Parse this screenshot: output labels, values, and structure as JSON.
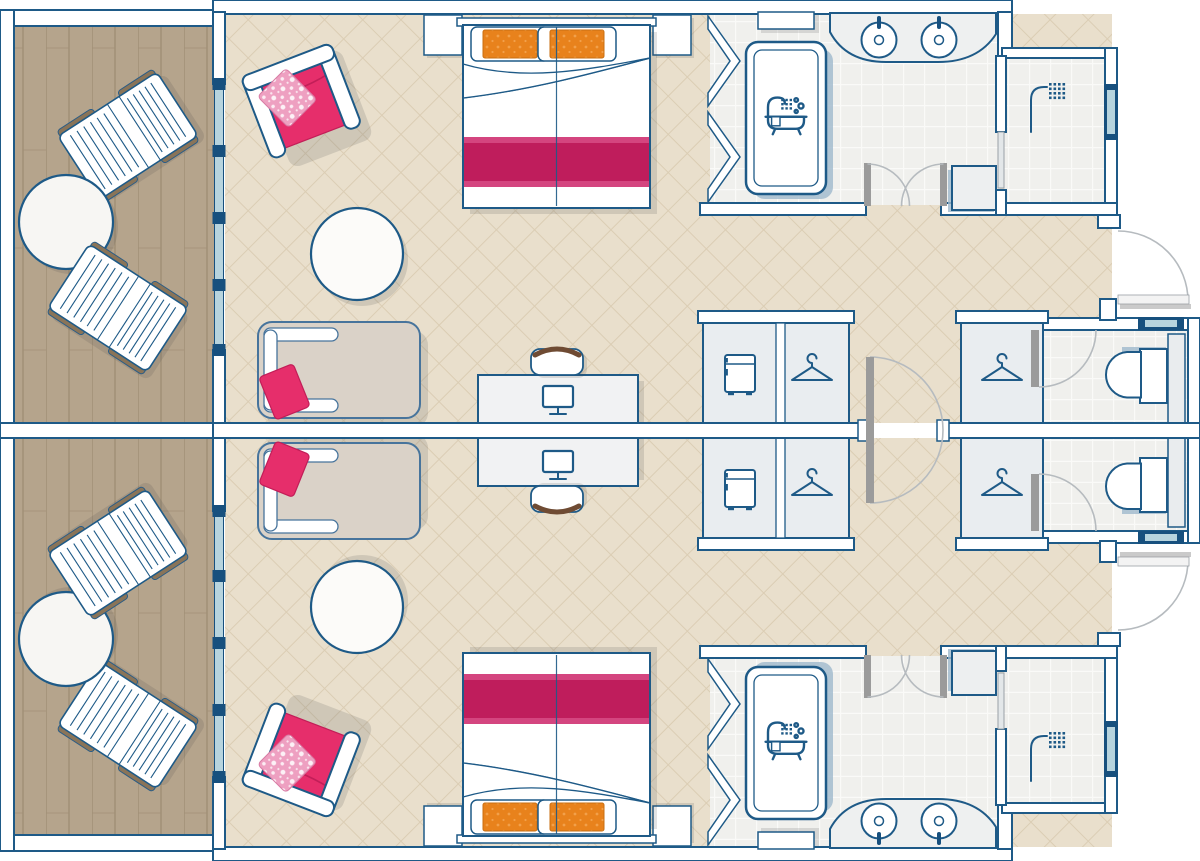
{
  "document": {
    "type": "floor-plan",
    "description": "Floor plan of two mirrored connecting hotel rooms, each with balcony, bedroom, walk-in closets, bathroom, shower room and WC",
    "visible_text": []
  },
  "palette": {
    "wall_stroke": "#1e5a87",
    "wall_fill": "#ffffff",
    "floor_bedroom": "#e9dfcc",
    "floor_grid": "#dbcdb4",
    "floor_deck": "#b5a48c",
    "deck_line": "#a08f76",
    "floor_tile": "#f0f0ed",
    "tile_line": "#fafaf8",
    "closet_fill": "#e9edf0",
    "glass": "#b7d4de",
    "glass_frame": "#17507e",
    "pink": "#e62e6b",
    "pink_dark": "#c21e58",
    "runner": "#bf1d5c",
    "runner_light": "#d4457f",
    "orange": "#e8821c",
    "orange_dot": "#f2a04a",
    "floral": "#eea0c1",
    "chaise": "#dad2c8",
    "chaise_stroke": "#47749c",
    "rail": "#8a7458",
    "chair_back": "#6f4b33",
    "door_leaf": "#9b9b9b",
    "swing_arc": "#b6bbbf"
  },
  "icons": [
    "hanger-icon",
    "minibar-fridge-icon",
    "monitor-icon",
    "shower-icon",
    "bathtub-icon",
    "sink-icon",
    "toilet-icon",
    "window-glyph"
  ],
  "floor_plan": {
    "layout": "two mirrored suites about horizontal centerline",
    "suites": [
      {
        "id": "top",
        "balcony": {
          "floor": "wood-deck",
          "furniture": [
            "sun-lounger",
            "round-table",
            "sun-lounger"
          ]
        },
        "bedroom": {
          "floor": "beige-lattice",
          "furniture": [
            "pink-armchair-with-floral-cushion",
            "double-bed-with-two-orange-pillows-and-magenta-runner",
            "nightstand",
            "nightstand",
            "round-side-table",
            "chaise-lounge-with-pink-pillow",
            "desk",
            "desk-chair",
            "monitor"
          ]
        },
        "storage": {
          "units": [
            "minibar-fridge-cabinet",
            "wardrobe-with-hanger",
            "second-wardrobe-with-hanger"
          ]
        },
        "bathroom": {
          "floor": "light-tile",
          "fixtures": [
            "bathtub",
            "double-sink-vanity",
            "shelf",
            "double-swing-doors",
            "cabinet",
            "glass-partition-zigzag"
          ]
        },
        "shower_room": {
          "fixtures": [
            "shower-head",
            "exterior-window",
            "glass-door"
          ]
        },
        "wc": {
          "fixtures": [
            "toilet",
            "small-window",
            "swing-door",
            "storage-strip"
          ]
        },
        "doors": [
          "entry-door-with-quarter-swing",
          "shared-connecting-door-with-half-swing"
        ]
      },
      {
        "id": "bottom",
        "mirrored_copy_of": "top"
      }
    ]
  }
}
